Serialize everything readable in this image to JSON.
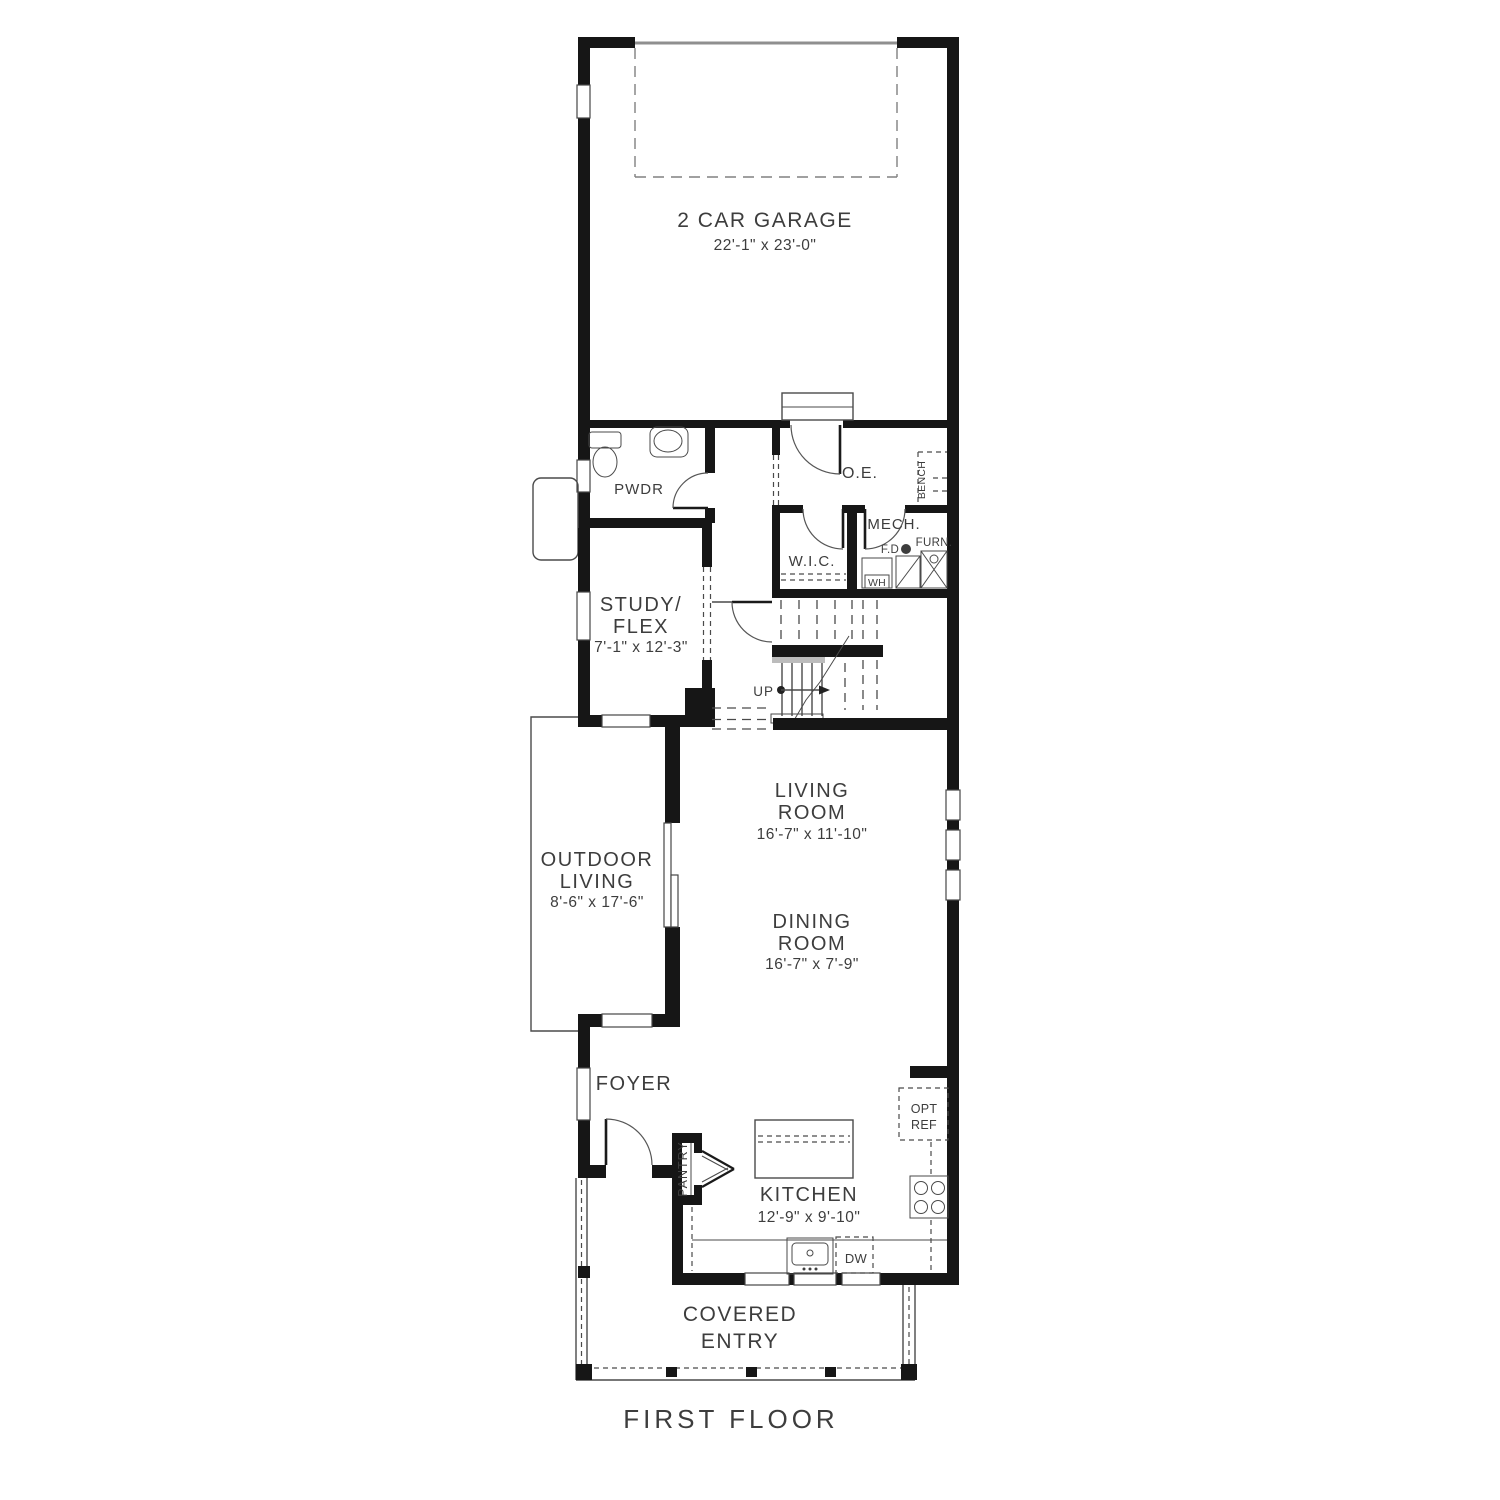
{
  "floor_label": "FIRST FLOOR",
  "colors": {
    "wall": "#161616",
    "line": "#4a4a4a",
    "text": "#3d3d3d",
    "garage_door": "#8f8f8f",
    "stair_nosing": "#bcbcbc"
  },
  "rooms": {
    "garage": {
      "name": "2 CAR GARAGE",
      "dims": "22'-1\" x 23'-0\""
    },
    "powder": {
      "name": "PWDR"
    },
    "owners_entry": {
      "name": "O.E."
    },
    "bench": {
      "name": "BENCH"
    },
    "mech": {
      "name": "MECH."
    },
    "furnace": {
      "name": "FURN."
    },
    "floor_drain": {
      "name": "F.D"
    },
    "water_heater": {
      "name": "WH"
    },
    "closet": {
      "name": "W.I.C."
    },
    "study": {
      "line1": "STUDY/",
      "line2": "FLEX",
      "dims": "7'-1\" x 12'-3\""
    },
    "stairs": {
      "up": "UP"
    },
    "living": {
      "line1": "LIVING",
      "line2": "ROOM",
      "dims": "16'-7\" x 11'-10\""
    },
    "outdoor": {
      "line1": "OUTDOOR",
      "line2": "LIVING",
      "dims": "8'-6\" x 17'-6\""
    },
    "dining": {
      "line1": "DINING",
      "line2": "ROOM",
      "dims": "16'-7\" x 7'-9\""
    },
    "foyer": {
      "name": "FOYER"
    },
    "pantry": {
      "name": "PANTRY"
    },
    "kitchen": {
      "name": "KITCHEN",
      "dims": "12'-9\" x 9'-10\""
    },
    "opt_ref": {
      "line1": "OPT",
      "line2": "REF"
    },
    "dishwasher": {
      "name": "DW"
    },
    "entry": {
      "line1": "COVERED",
      "line2": "ENTRY"
    }
  }
}
